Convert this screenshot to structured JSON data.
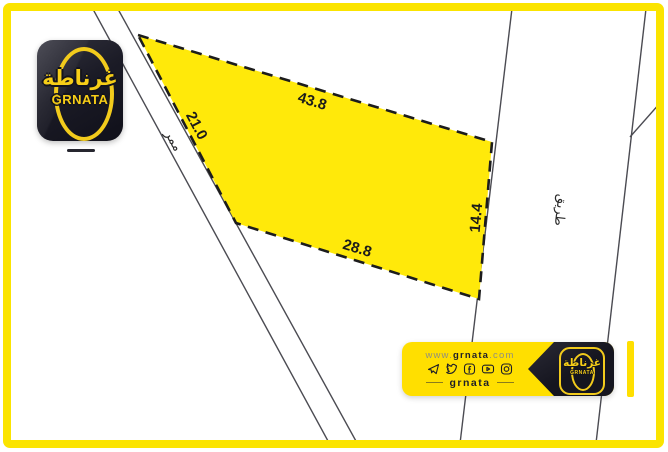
{
  "logo": {
    "arabic": "غرناطة",
    "latin": "GRNATA"
  },
  "plot": {
    "side_top": "43.8",
    "side_right": "14.4",
    "side_bottom": "28.8",
    "side_left": "21.0"
  },
  "roads": {
    "passage_label": "ممر",
    "road_label": "طريق"
  },
  "footer": {
    "website": {
      "prefix": "www.",
      "name": "grnata",
      "suffix": ".com"
    },
    "social_icons": [
      "telegram-icon",
      "twitter-icon",
      "facebook-icon",
      "youtube-icon",
      "instagram-icon"
    ],
    "handle": "grnata",
    "logo": {
      "arabic": "غرناطة",
      "latin": "GRNATA"
    }
  },
  "colors": {
    "frame_yellow": "#FBE400",
    "plot_yellow": "#FFE90A",
    "banner_yellow": "#FFDF00",
    "dark_navy": "#15151F",
    "logo_yellow": "#F7CE17",
    "road_line_gray": "#4B4B52",
    "plot_outline_black": "#1C1C1C"
  }
}
